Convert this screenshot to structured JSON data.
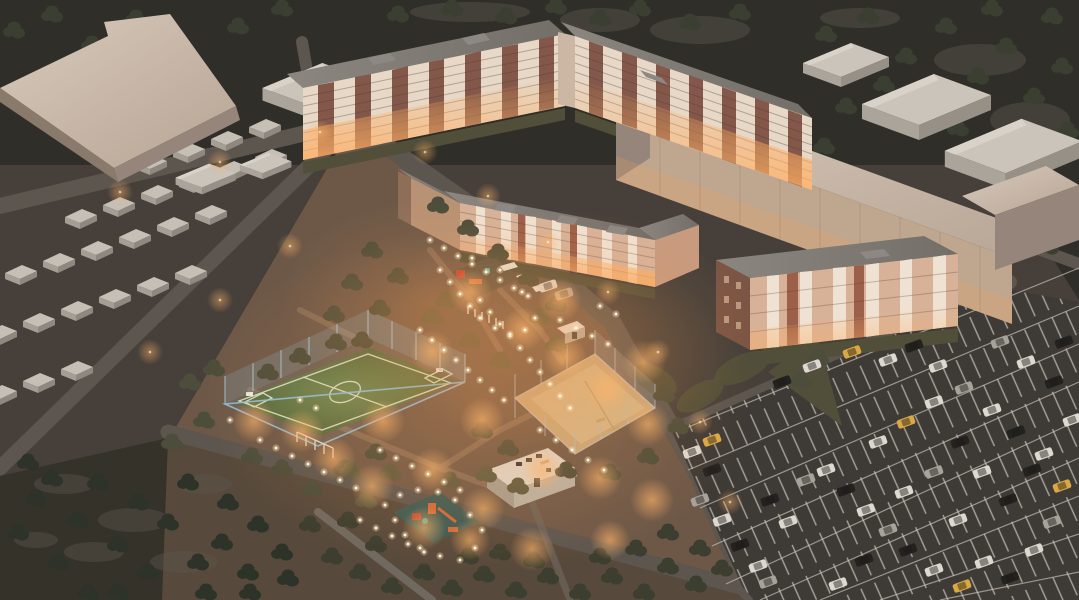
{
  "scene": {
    "title": "Aerial dusk render of a residential complex with lit courtyard, sports fields, garages and parking",
    "setting": "evening architectural visualization, bird's-eye view",
    "lighting": "warm street lamps and white in-ground path lights over the central courtyard"
  },
  "palette": {
    "base": "#47403a",
    "topband": "#2f2e28",
    "woodland": "#343229",
    "bottomCourt": "#57493b",
    "courtyard": "#6d5848",
    "road": "#5c564f",
    "roadMinor": "#6f685e",
    "parking": "#3e3a36",
    "stallLine": "#cdc6bb",
    "turf": "#5d7747",
    "turfLine": "#d2dcc2",
    "fenceBlue": "#8fc0dc",
    "sand": "#c9a87a",
    "beigeRoof": "#cfc0b1",
    "beigeFace": "#bfa68f",
    "beigeShade": "#96857a",
    "roofGrey": "#7f7a74",
    "cream": "#e7d8c7",
    "brick": "#83584a",
    "salmon": "#d7b299",
    "salmonBrick": "#9c5f4a",
    "darkBrickFace": "#7d5544",
    "litWindow": "#ffc98e",
    "rubberPad": "#3c5a54",
    "equipOrange": "#d2693a",
    "equipRed": "#bf3f2f",
    "equipTeal": "#3fae9e",
    "glow": "#ffb065",
    "pathLight": "#fff5e2",
    "treeDark": "#3a3f31",
    "treeOlive": "#4c4d3a",
    "treeWood": "#2e332a",
    "grass": "#514e39",
    "grassLit": "#615c40",
    "carWhite": "#ded9d0",
    "carBlack": "#24221f",
    "carYellow": "#d9a844",
    "carSilver": "#a7a29a",
    "garageRoof": "#c6bfb5",
    "garageFront": "#8e8880"
  },
  "buildings": {
    "slab_west": {
      "label": "9-storey apartment block, brick with white balconies"
    },
    "slab_east": {
      "label": "9-storey apartment block, brick with white balconies"
    },
    "courtyard_block": {
      "label": "5-storey U-shaped apartment block"
    },
    "east_block": {
      "label": "4-storey apartment block"
    },
    "hall_west": {
      "label": "large windowless industrial hall"
    },
    "hall_east": {
      "label": "long windowless industrial hall"
    },
    "warehouses": {
      "label": "pitched-roof warehouse sheds"
    },
    "garages": {
      "label": "rows of garage boxes"
    },
    "utility": {
      "label": "single-storey utility building"
    },
    "kiosk": {
      "label": "courtyard kiosk"
    }
  },
  "amenities": {
    "soccer_field": {
      "label": "mini football pitch",
      "surface": "green turf",
      "fence": "light blue chain-link"
    },
    "sand_court": {
      "label": "fenced sand sports court"
    },
    "playground_upper": {
      "label": "children's playground with canopies"
    },
    "playground_lower": {
      "label": "children's playground on rubber pad"
    },
    "pergola": {
      "label": "pergola posts"
    },
    "benches": {
      "label": "wooden benches"
    }
  },
  "parking_lot": {
    "label": "large surface parking with angled white stall markings and scattered cars"
  },
  "vegetation": {
    "forest": "dark tree massif at top and bottom-left",
    "bushes": "olive shrubs along paths"
  }
}
